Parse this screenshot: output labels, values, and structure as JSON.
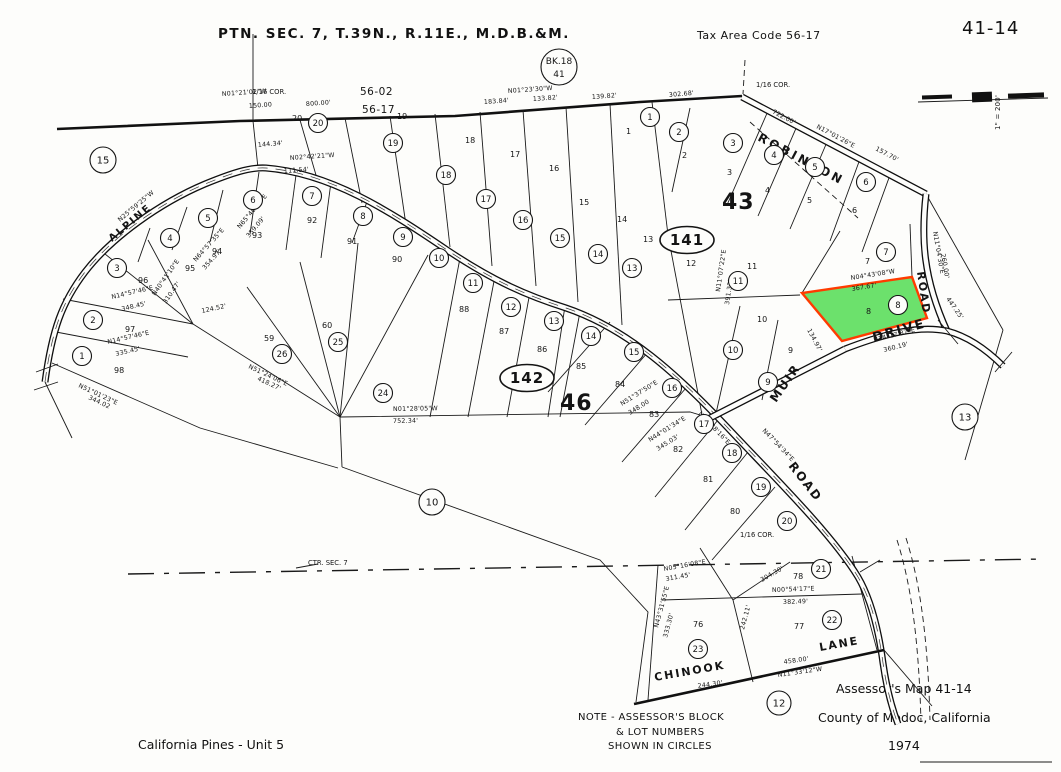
{
  "header": {
    "title": "PTN. SEC. 7, T.39N., R.11E., M.D.B.&M.",
    "tax_area_code": "Tax Area Code 56-17",
    "sheet_number": "41-14"
  },
  "book_circle": {
    "line1": "BK.18",
    "line2": "41"
  },
  "scale_bar": {
    "label": "1\" = 200'"
  },
  "note": {
    "line1": "NOTE - ASSESSOR'S BLOCK",
    "line2": "& LOT NUMBERS",
    "line3": "SHOWN IN CIRCLES"
  },
  "footer": {
    "map_title": "Assessor's Map 41-14",
    "county": "County of Modoc, California",
    "year": "1974",
    "subdivision": "California Pines - Unit 5"
  },
  "highlighted_parcel": {
    "lot_number": "8",
    "fill_color": "#5FDE5F",
    "outline_color": "#FF3B00"
  },
  "map": {
    "block_ovals": [
      {
        "text": "141",
        "x": 687,
        "y": 240
      },
      {
        "text": "142",
        "x": 527,
        "y": 378
      }
    ],
    "block_labels": [
      {
        "text": "43",
        "x": 722,
        "y": 209
      },
      {
        "text": "46",
        "x": 560,
        "y": 410
      }
    ],
    "boundary_codes": [
      {
        "text": "56-02",
        "x": 360,
        "y": 95
      },
      {
        "text": "56-17",
        "x": 362,
        "y": 113
      }
    ],
    "road_names": [
      {
        "text": "ROBINSON",
        "x": 757,
        "y": 140,
        "rot": 28,
        "size": 12,
        "spacing": 3
      },
      {
        "text": "ALPINE",
        "x": 112,
        "y": 242,
        "rot": -40,
        "size": 10,
        "spacing": 2
      },
      {
        "text": "MUIR",
        "x": 776,
        "y": 403,
        "rot": -55,
        "size": 12,
        "spacing": 2
      },
      {
        "text": "ROAD",
        "x": 788,
        "y": 466,
        "rot": 52,
        "size": 12,
        "spacing": 2
      },
      {
        "text": "ROAD",
        "x": 917,
        "y": 272,
        "rot": 82,
        "size": 11,
        "spacing": 2
      },
      {
        "text": "DRIVE",
        "x": 874,
        "y": 342,
        "rot": -16,
        "size": 13,
        "spacing": 2
      },
      {
        "text": "CHINOOK",
        "x": 655,
        "y": 681,
        "rot": -10,
        "size": 11,
        "spacing": 2
      },
      {
        "text": "LANE",
        "x": 820,
        "y": 651,
        "rot": -10,
        "size": 11,
        "spacing": 2
      }
    ],
    "corner_labels": [
      {
        "text": "1/16 COR.",
        "x": 252,
        "y": 94
      },
      {
        "text": "1/16 COR.",
        "x": 756,
        "y": 87
      },
      {
        "text": "1/16 COR.",
        "x": 740,
        "y": 537
      },
      {
        "text": "CTR. SEC. 7",
        "x": 308,
        "y": 565
      }
    ],
    "circled_numbers": [
      {
        "text": "15",
        "x": 103,
        "y": 160,
        "r": 13
      },
      {
        "text": "10",
        "x": 432,
        "y": 502,
        "r": 13
      },
      {
        "text": "13",
        "x": 965,
        "y": 417,
        "r": 13
      },
      {
        "text": "12",
        "x": 779,
        "y": 703,
        "r": 12
      },
      {
        "text": "20",
        "x": 318,
        "y": 123
      },
      {
        "text": "19",
        "x": 393,
        "y": 143
      },
      {
        "text": "18",
        "x": 446,
        "y": 175
      },
      {
        "text": "17",
        "x": 486,
        "y": 199
      },
      {
        "text": "16",
        "x": 523,
        "y": 220
      },
      {
        "text": "15",
        "x": 560,
        "y": 238
      },
      {
        "text": "14",
        "x": 598,
        "y": 254
      },
      {
        "text": "13",
        "x": 632,
        "y": 268
      },
      {
        "text": "8",
        "x": 363,
        "y": 216
      },
      {
        "text": "9",
        "x": 403,
        "y": 237
      },
      {
        "text": "10",
        "x": 439,
        "y": 258
      },
      {
        "text": "11",
        "x": 473,
        "y": 283
      },
      {
        "text": "12",
        "x": 511,
        "y": 307
      },
      {
        "text": "13",
        "x": 554,
        "y": 321
      },
      {
        "text": "14",
        "x": 591,
        "y": 336
      },
      {
        "text": "15",
        "x": 634,
        "y": 352
      },
      {
        "text": "16",
        "x": 672,
        "y": 388
      },
      {
        "text": "17",
        "x": 704,
        "y": 424
      },
      {
        "text": "18",
        "x": 732,
        "y": 453
      },
      {
        "text": "19",
        "x": 761,
        "y": 487
      },
      {
        "text": "20",
        "x": 787,
        "y": 521
      },
      {
        "text": "21",
        "x": 821,
        "y": 569
      },
      {
        "text": "22",
        "x": 832,
        "y": 620
      },
      {
        "text": "23",
        "x": 698,
        "y": 649
      },
      {
        "text": "3",
        "x": 117,
        "y": 268
      },
      {
        "text": "4",
        "x": 170,
        "y": 238
      },
      {
        "text": "5",
        "x": 208,
        "y": 218
      },
      {
        "text": "6",
        "x": 253,
        "y": 200
      },
      {
        "text": "7",
        "x": 312,
        "y": 196
      },
      {
        "text": "2",
        "x": 93,
        "y": 320
      },
      {
        "text": "1",
        "x": 82,
        "y": 356
      },
      {
        "text": "26",
        "x": 282,
        "y": 354
      },
      {
        "text": "25",
        "x": 338,
        "y": 342
      },
      {
        "text": "24",
        "x": 383,
        "y": 393
      },
      {
        "text": "1",
        "x": 650,
        "y": 117
      },
      {
        "text": "2",
        "x": 679,
        "y": 132
      },
      {
        "text": "3",
        "x": 733,
        "y": 143
      },
      {
        "text": "4",
        "x": 774,
        "y": 155
      },
      {
        "text": "5",
        "x": 815,
        "y": 167
      },
      {
        "text": "6",
        "x": 866,
        "y": 182
      },
      {
        "text": "7",
        "x": 886,
        "y": 252
      },
      {
        "text": "8",
        "x": 898,
        "y": 305
      },
      {
        "text": "11",
        "x": 738,
        "y": 281
      },
      {
        "text": "10",
        "x": 733,
        "y": 350
      },
      {
        "text": "9",
        "x": 768,
        "y": 382
      }
    ],
    "lot_numbers": [
      {
        "text": "20",
        "x": 292,
        "y": 121
      },
      {
        "text": "19",
        "x": 397,
        "y": 119
      },
      {
        "text": "18",
        "x": 465,
        "y": 143
      },
      {
        "text": "17",
        "x": 510,
        "y": 157
      },
      {
        "text": "16",
        "x": 549,
        "y": 171
      },
      {
        "text": "15",
        "x": 579,
        "y": 205
      },
      {
        "text": "14",
        "x": 617,
        "y": 222
      },
      {
        "text": "13",
        "x": 643,
        "y": 242
      },
      {
        "text": "1",
        "x": 626,
        "y": 134
      },
      {
        "text": "2",
        "x": 682,
        "y": 158
      },
      {
        "text": "3",
        "x": 727,
        "y": 175
      },
      {
        "text": "4",
        "x": 765,
        "y": 193
      },
      {
        "text": "5",
        "x": 807,
        "y": 203
      },
      {
        "text": "6",
        "x": 852,
        "y": 213
      },
      {
        "text": "7",
        "x": 865,
        "y": 264
      },
      {
        "text": "12",
        "x": 686,
        "y": 266
      },
      {
        "text": "11",
        "x": 747,
        "y": 269
      },
      {
        "text": "10",
        "x": 757,
        "y": 322
      },
      {
        "text": "9",
        "x": 788,
        "y": 353
      },
      {
        "text": "8",
        "x": 866,
        "y": 314
      },
      {
        "text": "96",
        "x": 138,
        "y": 283
      },
      {
        "text": "95",
        "x": 185,
        "y": 271
      },
      {
        "text": "94",
        "x": 212,
        "y": 254
      },
      {
        "text": "93",
        "x": 252,
        "y": 238
      },
      {
        "text": "92",
        "x": 307,
        "y": 223
      },
      {
        "text": "91",
        "x": 347,
        "y": 244
      },
      {
        "text": "90",
        "x": 392,
        "y": 262
      },
      {
        "text": "97",
        "x": 125,
        "y": 332
      },
      {
        "text": "98",
        "x": 114,
        "y": 373
      },
      {
        "text": "59",
        "x": 264,
        "y": 341
      },
      {
        "text": "60",
        "x": 322,
        "y": 328
      },
      {
        "text": "88",
        "x": 459,
        "y": 312
      },
      {
        "text": "87",
        "x": 499,
        "y": 334
      },
      {
        "text": "86",
        "x": 537,
        "y": 352
      },
      {
        "text": "85",
        "x": 576,
        "y": 369
      },
      {
        "text": "84",
        "x": 615,
        "y": 387
      },
      {
        "text": "83",
        "x": 649,
        "y": 417
      },
      {
        "text": "82",
        "x": 673,
        "y": 452
      },
      {
        "text": "81",
        "x": 703,
        "y": 482
      },
      {
        "text": "80",
        "x": 730,
        "y": 514
      },
      {
        "text": "76",
        "x": 693,
        "y": 627
      },
      {
        "text": "77",
        "x": 794,
        "y": 629
      },
      {
        "text": "78",
        "x": 793,
        "y": 579
      }
    ],
    "survey_labels": [
      {
        "text": "N01°21'02\"W",
        "x": 222,
        "y": 96,
        "rot": -4
      },
      {
        "text": "150.00",
        "x": 249,
        "y": 108,
        "rot": -4
      },
      {
        "text": "800.00'",
        "x": 306,
        "y": 106,
        "rot": -4
      },
      {
        "text": "N01°23'30\"W",
        "x": 508,
        "y": 93,
        "rot": -4
      },
      {
        "text": "183.84'",
        "x": 484,
        "y": 104,
        "rot": -4
      },
      {
        "text": "133.82'",
        "x": 533,
        "y": 101,
        "rot": -4
      },
      {
        "text": "139.82'",
        "x": 592,
        "y": 99,
        "rot": -4
      },
      {
        "text": "302.68'",
        "x": 669,
        "y": 97,
        "rot": -5
      },
      {
        "text": "722.00'",
        "x": 772,
        "y": 113,
        "rot": 28
      },
      {
        "text": "N17°01'26\"E",
        "x": 816,
        "y": 128,
        "rot": 28
      },
      {
        "text": "157.70'",
        "x": 875,
        "y": 150,
        "rot": 28
      },
      {
        "text": "144.34'",
        "x": 258,
        "y": 147,
        "rot": -5
      },
      {
        "text": "N02°42'21\"W",
        "x": 290,
        "y": 160,
        "rot": -4
      },
      {
        "text": "111.54'",
        "x": 284,
        "y": 173,
        "rot": -4
      },
      {
        "text": "N25°59'25\"W",
        "x": 120,
        "y": 222,
        "rot": -40
      },
      {
        "text": "N40°41'10\"E",
        "x": 155,
        "y": 296,
        "rot": -55
      },
      {
        "text": "310.47'",
        "x": 166,
        "y": 304,
        "rot": -55
      },
      {
        "text": "N64°57'35\"E",
        "x": 196,
        "y": 262,
        "rot": -48
      },
      {
        "text": "354.97'",
        "x": 205,
        "y": 270,
        "rot": -48
      },
      {
        "text": "N65°46'45\"E",
        "x": 240,
        "y": 229,
        "rot": -50
      },
      {
        "text": "359.09'",
        "x": 249,
        "y": 238,
        "rot": -50
      },
      {
        "text": "N14°57'46\"E",
        "x": 112,
        "y": 299,
        "rot": -13
      },
      {
        "text": "348.45'",
        "x": 122,
        "y": 311,
        "rot": -13
      },
      {
        "text": "N14°57'46\"E",
        "x": 108,
        "y": 344,
        "rot": -13
      },
      {
        "text": "335.45'",
        "x": 116,
        "y": 356,
        "rot": -13
      },
      {
        "text": "N51°01'23\"E",
        "x": 78,
        "y": 387,
        "rot": 25
      },
      {
        "text": "344.02",
        "x": 88,
        "y": 399,
        "rot": 25
      },
      {
        "text": "N51°24'06\"E",
        "x": 248,
        "y": 368,
        "rot": 25
      },
      {
        "text": "418.27'",
        "x": 257,
        "y": 380,
        "rot": 25
      },
      {
        "text": "124.52'",
        "x": 202,
        "y": 313,
        "rot": -12
      },
      {
        "text": "N01°28'05\"W",
        "x": 393,
        "y": 411,
        "rot": -1
      },
      {
        "text": "752.34'",
        "x": 393,
        "y": 423,
        "rot": -1
      },
      {
        "text": "N51°37'50\"E",
        "x": 622,
        "y": 406,
        "rot": -32
      },
      {
        "text": "348.00",
        "x": 630,
        "y": 415,
        "rot": -32
      },
      {
        "text": "N44°01'34\"E",
        "x": 650,
        "y": 442,
        "rot": -32
      },
      {
        "text": "345.03'",
        "x": 658,
        "y": 451,
        "rot": -32
      },
      {
        "text": "N43°28'16\"E",
        "x": 698,
        "y": 414,
        "rot": 46
      },
      {
        "text": "N47°54'34\"E",
        "x": 762,
        "y": 431,
        "rot": 46
      },
      {
        "text": "N11°07'22\"E",
        "x": 720,
        "y": 292,
        "rot": -82
      },
      {
        "text": "391.32'",
        "x": 729,
        "y": 305,
        "rot": -82
      },
      {
        "text": "N04°43'08\"W",
        "x": 851,
        "y": 280,
        "rot": -9
      },
      {
        "text": "367.67'",
        "x": 852,
        "y": 291,
        "rot": -9
      },
      {
        "text": "134.97'",
        "x": 807,
        "y": 330,
        "rot": 62
      },
      {
        "text": "N14°17'37\"E",
        "x": 874,
        "y": 342,
        "rot": -14
      },
      {
        "text": "360.19'",
        "x": 884,
        "y": 352,
        "rot": -14
      },
      {
        "text": "N11°04'30\"E",
        "x": 933,
        "y": 232,
        "rot": 80
      },
      {
        "text": "260.00'",
        "x": 941,
        "y": 254,
        "rot": 80
      },
      {
        "text": "447.25'",
        "x": 946,
        "y": 299,
        "rot": 55
      },
      {
        "text": "N00°54'17\"E",
        "x": 772,
        "y": 592,
        "rot": -2
      },
      {
        "text": "382.49'",
        "x": 783,
        "y": 604,
        "rot": -2
      },
      {
        "text": "N11°33'12\"W",
        "x": 778,
        "y": 677,
        "rot": -8
      },
      {
        "text": "458.00'",
        "x": 784,
        "y": 664,
        "rot": -8
      },
      {
        "text": "244.30'",
        "x": 698,
        "y": 688,
        "rot": -8
      },
      {
        "text": "N05°16'08\"E",
        "x": 664,
        "y": 571,
        "rot": -10
      },
      {
        "text": "311.45'",
        "x": 666,
        "y": 581,
        "rot": -10
      },
      {
        "text": "N43°31'55\"E",
        "x": 658,
        "y": 628,
        "rot": -75
      },
      {
        "text": "333.30'",
        "x": 667,
        "y": 638,
        "rot": -75
      },
      {
        "text": "242.11'",
        "x": 744,
        "y": 630,
        "rot": -75
      },
      {
        "text": "304.30'",
        "x": 762,
        "y": 582,
        "rot": -30
      }
    ]
  }
}
